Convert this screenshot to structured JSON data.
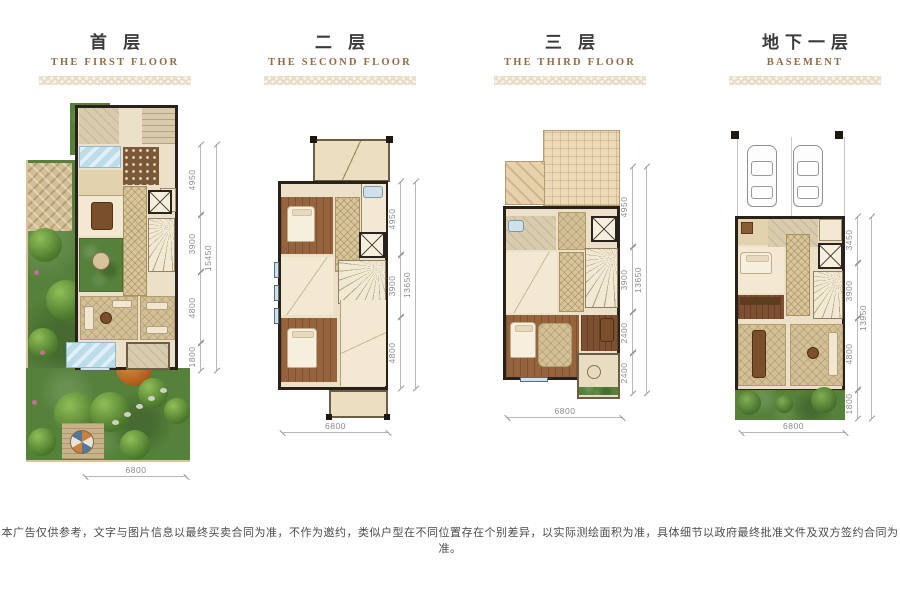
{
  "page": {
    "disclaimer": "本广告仅供参考，文字与图片信息以最终买卖合同为准，不作为邀约，类似户型在不同位置存在个别差异，以实际测绘面积为准，具体细节以政府最终批准文件及双方签约合同为准。"
  },
  "colors": {
    "accent_brown": "#8f6c4a",
    "title_gray": "#3b3b3b",
    "wall_dark": "#28221b",
    "floor_beige": "#ece0c8",
    "garden_green": "#55813a",
    "pool_blue": "#bcdcea",
    "dimension_gray": "#8a8a8a"
  },
  "plans": [
    {
      "title_cn": "首 层",
      "title_en": "THE FIRST FLOOR",
      "dims": [
        "4950",
        "3900",
        "4800",
        "1800"
      ],
      "total": "15450",
      "width": "6800"
    },
    {
      "title_cn": "二 层",
      "title_en": "THE SECOND FLOOR",
      "dims": [
        "4950",
        "3900",
        "4800"
      ],
      "total": "13650",
      "width": "6800"
    },
    {
      "title_cn": "三 层",
      "title_en": "THE THIRD FLOOR",
      "dims": [
        "4950",
        "3900",
        "2400",
        "2400"
      ],
      "total": "13650",
      "width": "6800"
    },
    {
      "title_cn": "地下一层",
      "title_en": "BASEMENT",
      "dims": [
        "3450",
        "3900",
        "4800",
        "1800"
      ],
      "total": "13950",
      "width": "6800"
    }
  ]
}
